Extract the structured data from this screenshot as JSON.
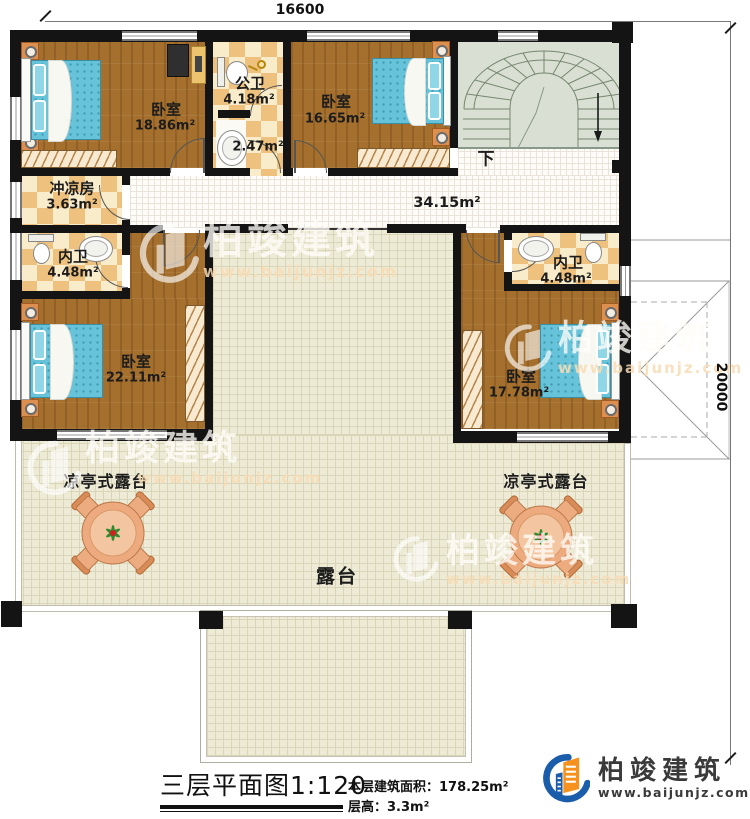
{
  "dimensions": {
    "top": "16600",
    "right": "20000"
  },
  "rooms": {
    "bedroom_tl": {
      "name": "卧室",
      "area": "18.86m²"
    },
    "public_bath": {
      "name": "公卫",
      "area": "4.18m²"
    },
    "small_bath": {
      "area": "2.47m²"
    },
    "bedroom_tr": {
      "name": "卧室",
      "area": "16.65m²"
    },
    "shower_room": {
      "name": "冲凉房",
      "area": "3.63m²"
    },
    "hallway": {
      "area": "34.15m²"
    },
    "bath_left": {
      "name": "内卫",
      "area": "4.48m²"
    },
    "bedroom_bl": {
      "name": "卧室",
      "area": "22.11m²"
    },
    "bath_right": {
      "name": "内卫",
      "area": "4.48m²"
    },
    "bedroom_br": {
      "name": "卧室",
      "area": "17.78m²"
    },
    "pavilion_terrace_left": {
      "name": "凉亭式露台"
    },
    "pavilion_terrace_right": {
      "name": "凉亭式露台"
    },
    "terrace": {
      "name": "露台"
    }
  },
  "stairs": {
    "direction_label": "下"
  },
  "watermark": {
    "brand": "柏竣建筑",
    "url": "www.baijunjz.com"
  },
  "title_block": {
    "title": "三层平面图1:120",
    "area_label": "本层建筑面积：",
    "area_value": "178.25m²",
    "height_label": "层高：",
    "height_value": "3.3m²"
  },
  "logo": {
    "brand": "柏竣建筑",
    "url": "www.baijunjz.com"
  },
  "colors": {
    "wall": "#141414",
    "wood_floor": "#a5702e",
    "tile_dark": "#eec17e",
    "tile_light": "#f9ecca",
    "terrace": "#edead6",
    "stair": "#d9e0d3",
    "mattress_blue": "#67c3da",
    "furniture_orange": "#dd8f4f",
    "logo_blue": "#1a5dab",
    "logo_orange": "#f5921e"
  }
}
